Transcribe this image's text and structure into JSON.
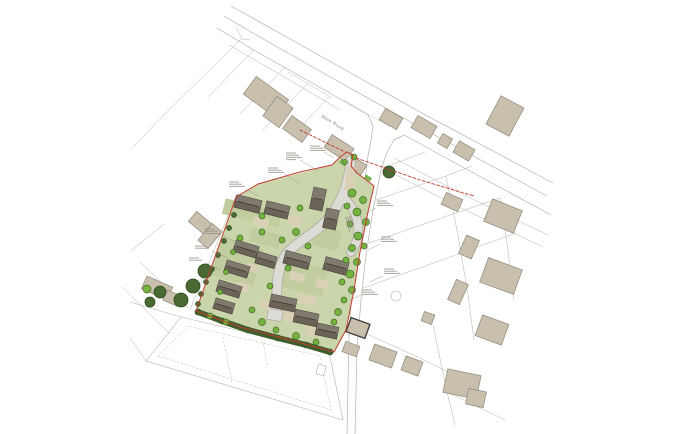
{
  "document": {
    "kind": "architectural site layout plan drawing"
  },
  "labels": {
    "road_label": "Main Road"
  },
  "palette": {
    "bg": "#ffffff",
    "line_grey": "#b4b0a7",
    "tan_building": "#c8c0ad",
    "tan_stroke": "#8e897c",
    "dark_outline": "#3a3833",
    "site_green": "#cbd5ac",
    "garden_green": "#c1cd9e",
    "verge_green": "#79b24a",
    "tree_green": "#74b13e",
    "tree_green_stroke": "#466d2a",
    "tree_dark": "#4a6a33",
    "tree_dark_stroke": "#2e481d",
    "hedge_green": "#3e5f2b",
    "roof_dark": "#6b6357",
    "roof_stroke": "#39342c",
    "ridge": "#332e27",
    "road_grey": "#dcdbd6",
    "road_edge": "#a9a59c",
    "drive_tan": "#d9d0b6",
    "boundary_red": "#c23b2e",
    "note_grey": "#8d897e",
    "label_grey": "#8b8478"
  },
  "base_lines": [
    {
      "p": "231,6 292,40 420,112 553,183",
      "w": 0.7
    },
    {
      "p": "224,16 258,36 334,79 416,125 547,196",
      "w": 0.7
    },
    {
      "p": "217,28 252,49 328,92 368,115",
      "w": 0.7
    },
    {
      "p": "404,135 468,170 551,215",
      "w": 0.7
    },
    {
      "p": "368,115 373,126 371,141 368,156 363,195 357,240 352,285 349,335 347,434",
      "w": 0.7
    },
    {
      "p": "404,135 394,140 387,152 381,170 373,210 366,255 361,300 357,350 355,434",
      "w": 0.7
    },
    {
      "p": "229,45 298,85 340,110",
      "w": 0.5
    },
    {
      "p": "394,158 460,193 548,235",
      "w": 0.5
    },
    {
      "p": "386,170 455,205 543,247",
      "w": 0.5
    },
    {
      "p": "288,72 332,98",
      "w": 0.4
    },
    {
      "p": "344,100 390,127",
      "w": 0.4
    },
    {
      "p": "236,27 242,39 250,40",
      "w": 0.5
    },
    {
      "p": "242,38 163,116",
      "w": 0.5
    },
    {
      "p": "254,50 208,97",
      "w": 0.5
    },
    {
      "p": "285,67 240,114",
      "w": 0.5
    },
    {
      "p": "308,83 262,131",
      "w": 0.5
    },
    {
      "p": "329,97 291,137",
      "w": 0.5
    },
    {
      "p": "163,116 133,147",
      "w": 0.5
    },
    {
      "p": "131,251 164,224",
      "w": 0.5
    },
    {
      "p": "140,262 188,308",
      "w": 0.5
    },
    {
      "p": "122,287 170,334",
      "w": 0.5
    },
    {
      "p": "383,168 425,152",
      "w": 0.5
    },
    {
      "p": "376,200 446,176 472,166",
      "w": 0.5
    },
    {
      "p": "369,243 447,216 500,198",
      "w": 0.5
    },
    {
      "p": "363,288 442,260 516,233",
      "w": 0.5
    },
    {
      "p": "446,176 458,235 468,295 474,340",
      "w": 0.5
    },
    {
      "p": "500,198 508,250 514,300",
      "w": 0.5
    },
    {
      "p": "358,330 420,358 468,382",
      "w": 0.5
    },
    {
      "p": "433,325 447,392 455,425",
      "w": 0.5
    },
    {
      "p": "447,392 505,420",
      "w": 0.5
    },
    {
      "p": "146,361 181,317 329,352 343,420 146,361",
      "w": 0.6
    },
    {
      "p": "146,361 130,338",
      "w": 0.5
    },
    {
      "p": "181,317 130,302",
      "w": 0.5
    },
    {
      "p": "236,196 190,310",
      "w": 0.5
    }
  ],
  "dashed_lines": [
    {
      "p": "158,356 188,326 320,356 331,410 158,356",
      "w": 0.45,
      "dash": "2 2"
    },
    {
      "p": "223,337 232,383",
      "w": 0.45,
      "dash": "2 2"
    },
    {
      "p": "260,328 268,367",
      "w": 0.45,
      "dash": "2 2"
    }
  ],
  "circles": [
    [
      396,
      296,
      5
    ]
  ],
  "outline_rects": [
    [
      321,
      370,
      8,
      10,
      15
    ]
  ],
  "site": {
    "outline": "258,184 332,165 347,152 353,155 351,166 357,173 374,186 368,212 360,252 354,290 346,330 334,352 290,340 240,327 196,311 236,197",
    "hedge": "198,312 222,321 248,330 278,338 306,345 330,352",
    "gardens": [
      [
        252,
        213,
        58,
        16,
        14
      ],
      [
        237,
        262,
        44,
        40,
        17
      ],
      [
        300,
        277,
        52,
        28,
        14
      ],
      [
        327,
        238,
        26,
        20,
        15
      ],
      [
        265,
        238,
        30,
        14,
        15
      ]
    ],
    "verges": [
      [
        344,
        163,
        9,
        5,
        33
      ],
      [
        368,
        178,
        7,
        4,
        33
      ]
    ],
    "roads": [
      {
        "d": "M351,160 C349,180 344,194 336,208 C323,230 301,239 289,251 C280,261 276,278 277,300 L277,314",
        "w": 9
      },
      {
        "d": "M343,197 C352,206 357,214 358,226 C359,238 356,245 351,252",
        "w": 8
      }
    ],
    "turning": [
      275,
      315,
      15,
      11,
      10
    ],
    "drives": [
      [
        261,
        222,
        15,
        9,
        14
      ],
      [
        295,
        221,
        13,
        9,
        14
      ],
      [
        252,
        268,
        13,
        8,
        17
      ],
      [
        243,
        287,
        13,
        8,
        17
      ],
      [
        297,
        277,
        15,
        9,
        15
      ],
      [
        322,
        284,
        13,
        9,
        15
      ],
      [
        291,
        317,
        15,
        9,
        12
      ],
      [
        313,
        331,
        13,
        9,
        12
      ],
      [
        350,
        179,
        9,
        24,
        6
      ],
      [
        266,
        305,
        11,
        8,
        15
      ],
      [
        307,
        300,
        18,
        10,
        12
      ]
    ],
    "houses": [
      [
        248,
        204,
        26,
        13,
        14
      ],
      [
        277,
        210,
        24,
        13,
        14
      ],
      [
        318,
        199,
        13,
        22,
        12
      ],
      [
        331,
        219,
        13,
        20,
        12
      ],
      [
        246,
        249,
        24,
        12,
        17
      ],
      [
        237,
        269,
        24,
        12,
        17
      ],
      [
        229,
        289,
        24,
        12,
        17
      ],
      [
        224,
        306,
        20,
        11,
        17
      ],
      [
        266,
        260,
        20,
        12,
        17
      ],
      [
        297,
        260,
        26,
        13,
        15
      ],
      [
        336,
        266,
        24,
        13,
        15
      ],
      [
        283,
        303,
        26,
        13,
        12
      ],
      [
        306,
        318,
        24,
        13,
        12
      ],
      [
        327,
        331,
        22,
        12,
        12
      ]
    ],
    "shrubs": [
      [
        234,
        215
      ],
      [
        229,
        228
      ],
      [
        224,
        241
      ],
      [
        218,
        255
      ],
      [
        212,
        269
      ],
      [
        206,
        282
      ],
      [
        201,
        294
      ],
      [
        198,
        304
      ]
    ]
  },
  "red": {
    "boundary": "258,184 300,172 332,165 340,157 347,152 353,155 351,166 357,173 374,186 368,212 360,252 354,290 346,330 334,352 290,340 240,327 196,311 236,197 258,184",
    "splays": [
      "300,130 345,152",
      "356,158 420,180 474,196"
    ]
  },
  "buildings": [
    [
      266,
      97,
      40,
      22,
      36
    ],
    [
      278,
      112,
      20,
      24,
      36
    ],
    [
      297,
      129,
      24,
      16,
      36
    ],
    [
      339,
      148,
      26,
      15,
      33
    ],
    [
      357,
      166,
      16,
      12,
      33
    ],
    [
      391,
      119,
      20,
      13,
      30
    ],
    [
      424,
      127,
      22,
      14,
      30
    ],
    [
      445,
      141,
      11,
      11,
      30
    ],
    [
      464,
      151,
      18,
      13,
      30
    ],
    [
      505,
      116,
      26,
      32,
      28
    ],
    [
      452,
      202,
      18,
      13,
      24
    ],
    [
      503,
      216,
      32,
      24,
      22
    ],
    [
      469,
      247,
      14,
      20,
      24
    ],
    [
      501,
      276,
      36,
      26,
      20
    ],
    [
      458,
      292,
      13,
      22,
      24
    ],
    [
      358,
      328,
      20,
      15,
      20,
      "dark"
    ],
    [
      351,
      349,
      15,
      11,
      20
    ],
    [
      383,
      356,
      24,
      17,
      20
    ],
    [
      412,
      366,
      18,
      15,
      20
    ],
    [
      462,
      384,
      34,
      24,
      12
    ],
    [
      476,
      398,
      18,
      16,
      12
    ],
    [
      492,
      330,
      28,
      22,
      20
    ],
    [
      428,
      318,
      11,
      10,
      20
    ],
    [
      204,
      226,
      30,
      13,
      40
    ],
    [
      210,
      236,
      13,
      22,
      40
    ],
    [
      157,
      288,
      28,
      14,
      24
    ],
    [
      172,
      298,
      15,
      11,
      24
    ]
  ],
  "trees": {
    "light": [
      [
        354,
        157,
        3
      ],
      [
        345,
        162,
        2.5
      ],
      [
        352,
        193,
        4
      ],
      [
        363,
        200,
        3.5
      ],
      [
        347,
        206,
        3
      ],
      [
        357,
        212,
        4
      ],
      [
        366,
        222,
        3.5
      ],
      [
        350,
        224,
        3
      ],
      [
        358,
        236,
        4
      ],
      [
        364,
        246,
        3
      ],
      [
        352,
        248,
        3.5
      ],
      [
        346,
        260,
        3
      ],
      [
        357,
        262,
        3.5
      ],
      [
        350,
        274,
        4
      ],
      [
        342,
        282,
        3
      ],
      [
        352,
        290,
        3.5
      ],
      [
        344,
        300,
        3
      ],
      [
        338,
        312,
        3.5
      ],
      [
        334,
        322,
        3
      ],
      [
        296,
        232,
        3.5
      ],
      [
        282,
        240,
        3
      ],
      [
        262,
        232,
        3
      ],
      [
        240,
        238,
        3
      ],
      [
        308,
        246,
        3
      ],
      [
        233,
        252,
        2.5
      ],
      [
        226,
        272,
        2.5
      ],
      [
        220,
        292,
        2.5
      ],
      [
        288,
        268,
        3
      ],
      [
        270,
        286,
        3
      ],
      [
        262,
        322,
        3.5
      ],
      [
        276,
        330,
        3
      ],
      [
        296,
        336,
        3.5
      ],
      [
        316,
        342,
        3
      ],
      [
        252,
        310,
        3
      ],
      [
        300,
        208,
        3
      ],
      [
        262,
        216,
        3
      ],
      [
        210,
        316,
        3
      ],
      [
        226,
        322,
        3
      ],
      [
        147,
        289,
        4
      ]
    ],
    "dark": [
      [
        205,
        271,
        7
      ],
      [
        193,
        286,
        7
      ],
      [
        181,
        300,
        7
      ],
      [
        160,
        292,
        6
      ],
      [
        150,
        302,
        5
      ],
      [
        389,
        172,
        6
      ]
    ]
  },
  "annotations": [
    {
      "x": 286,
      "y": 153,
      "n": 4,
      "leader": "300,160 318,171",
      "illegible": true
    },
    {
      "x": 310,
      "y": 146,
      "n": 3,
      "leader": "324,152 334,158",
      "illegible": true
    },
    {
      "x": 268,
      "y": 168,
      "n": 3,
      "leader": "284,174 300,184",
      "illegible": true
    },
    {
      "x": 229,
      "y": 182,
      "n": 3,
      "leader": "246,189 258,196",
      "illegible": true
    },
    {
      "x": 205,
      "y": 229,
      "n": 3,
      "leader": "222,235 236,242",
      "illegible": true
    },
    {
      "x": 195,
      "y": 246,
      "n": 2,
      "leader": "212,251 228,258",
      "illegible": true
    },
    {
      "x": 189,
      "y": 258,
      "n": 2,
      "leader": "206,263 220,270",
      "illegible": true
    },
    {
      "x": 377,
      "y": 201,
      "n": 3,
      "leader": "376,208 366,214",
      "illegible": true
    },
    {
      "x": 381,
      "y": 237,
      "n": 3,
      "leader": "380,244 368,250",
      "illegible": true
    },
    {
      "x": 384,
      "y": 269,
      "n": 3,
      "leader": "383,276 370,282",
      "illegible": true
    },
    {
      "x": 362,
      "y": 290,
      "n": 3,
      "leader": "361,295 350,300",
      "illegible": true
    },
    {
      "x": 350,
      "y": 216,
      "n": 3,
      "rot": 75,
      "illegible": true
    }
  ]
}
